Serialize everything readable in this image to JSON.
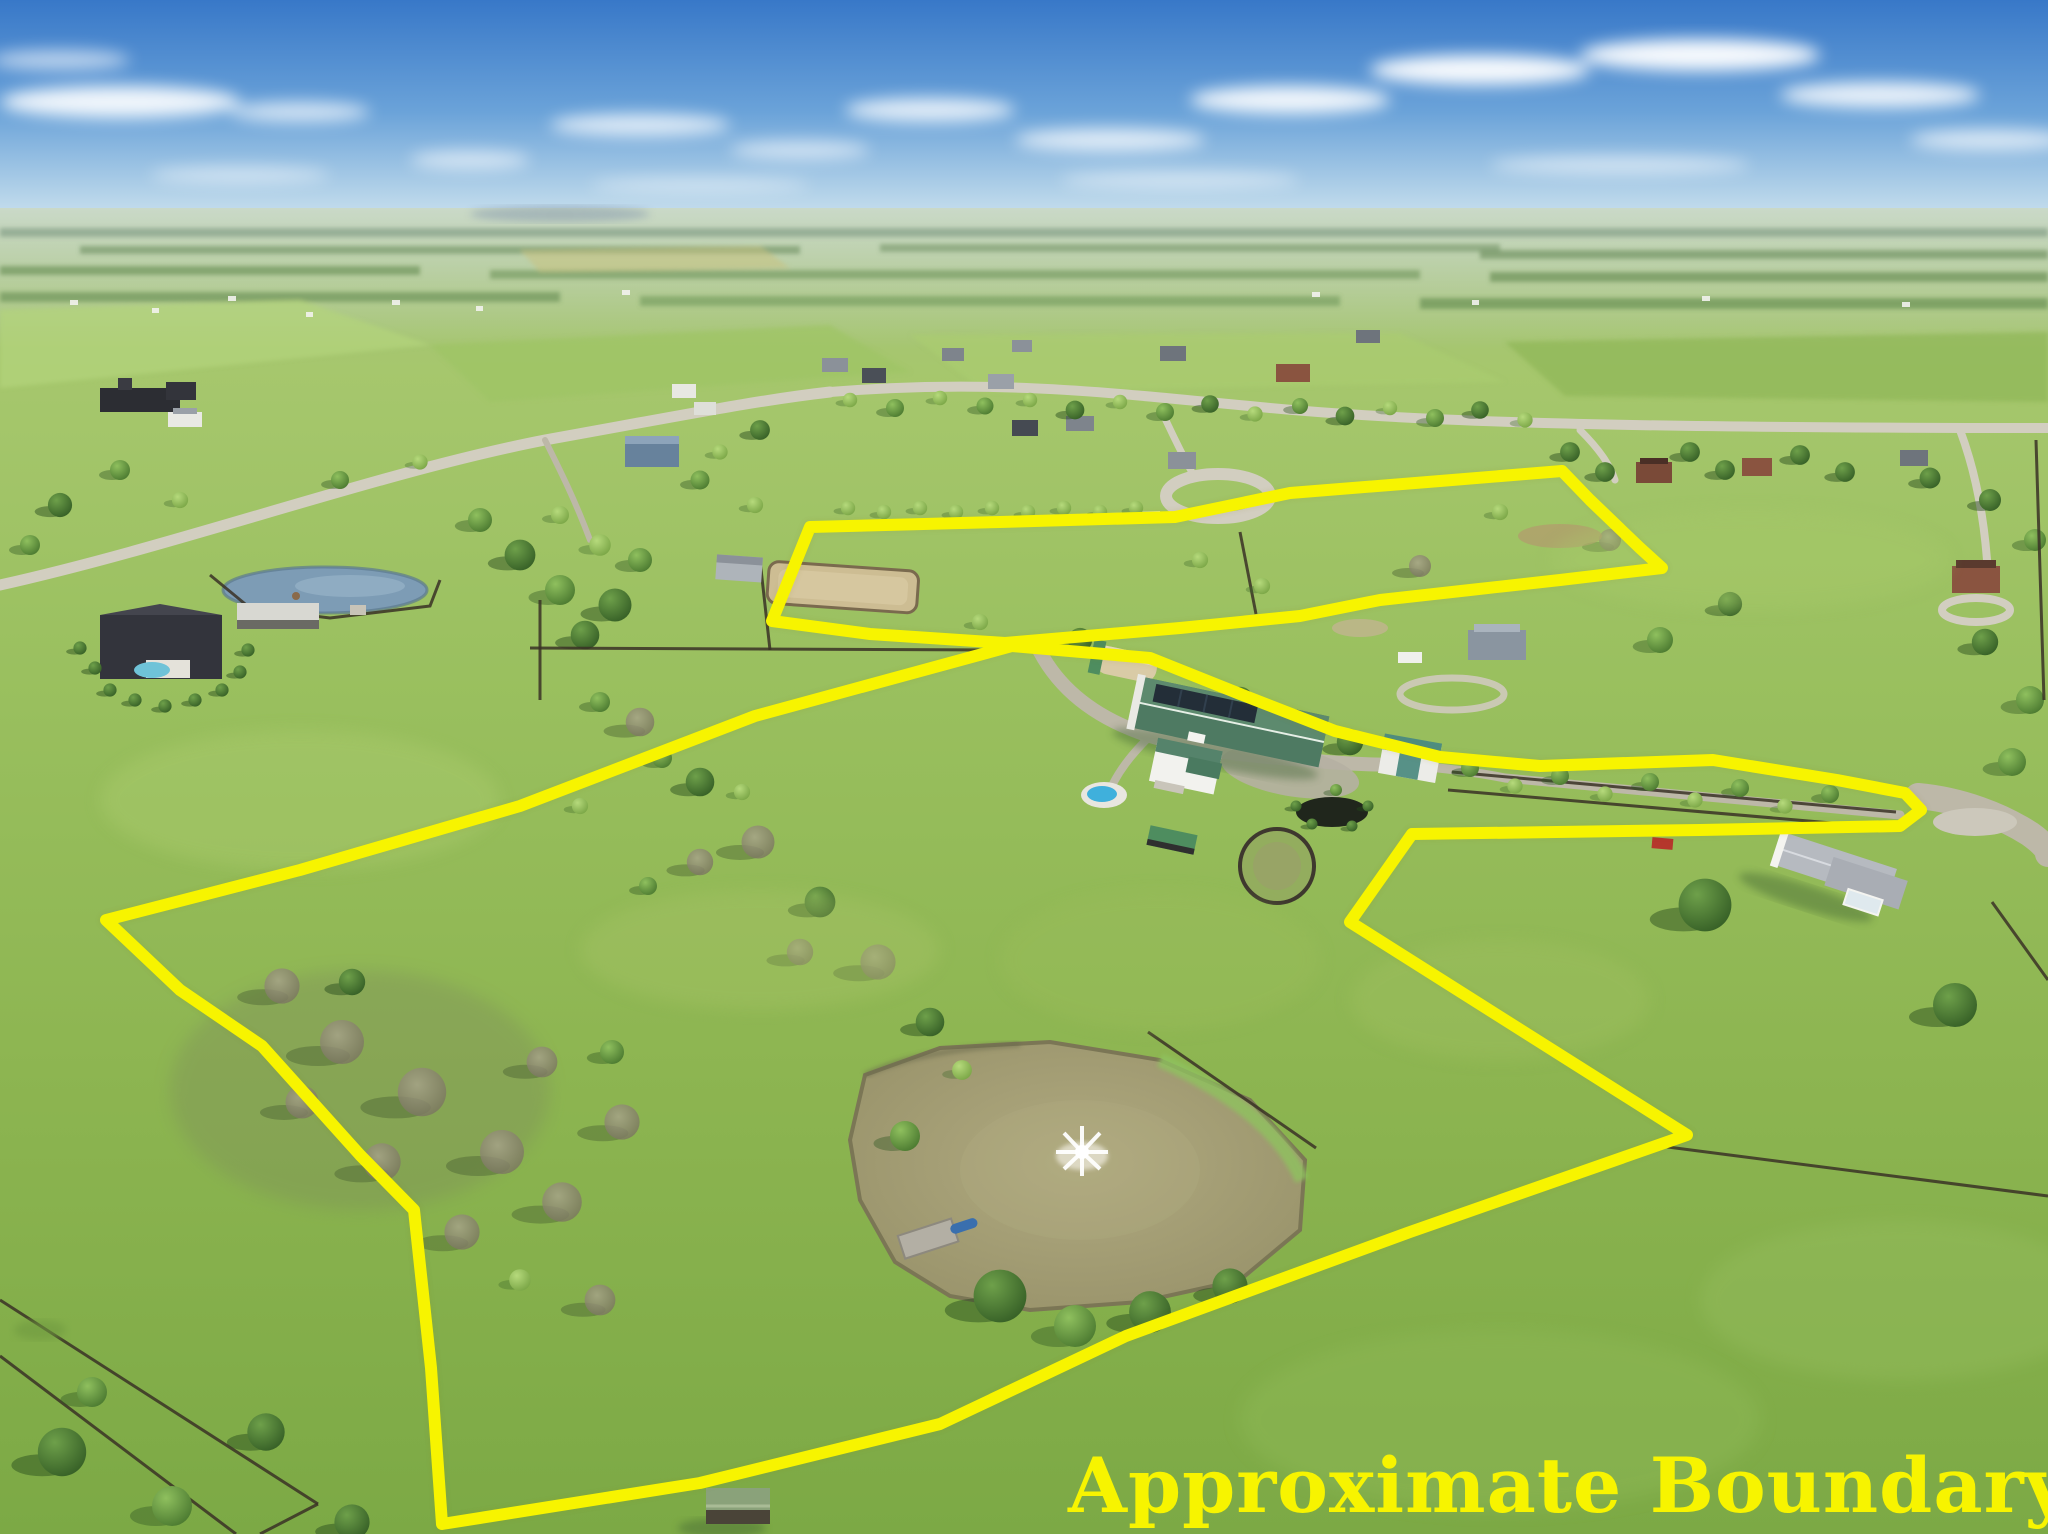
{
  "image": {
    "type": "aerial-drone-photograph",
    "title": "Aerial view of rural horse-farm property with boundary overlay"
  },
  "annotation": {
    "label": "Approximate Boundary",
    "line_color": "#f7f400",
    "line_width": 12,
    "parcels": [
      {
        "name": "main-parcel-boundary",
        "points": "1012,646 1150,658 1240,694 1335,731 1440,757 1540,766 1713,760 1837,780 1905,793 1921,810 1900,826 1700,830 1412,834 1350,922 1687,1135 1410,1232 1126,1336 940,1424 700,1483 442,1524 431,1368 414,1210 360,1155 262,1046 180,990 106,920 300,870 520,806 755,716"
      },
      {
        "name": "north-parcel-boundary",
        "points": "810,527 1000,522 1175,517 1290,493 1440,481 1562,471 1590,500 1640,548 1662,568 1560,580 1470,590 1380,600 1300,616 1180,628 1005,643 870,634 772,621"
      }
    ]
  },
  "scene": {
    "sky": {
      "zenith_color": "#3878c8",
      "horizon_color": "#e2eef5",
      "clouds": "scattered white cumulus and thin stratus"
    },
    "features": [
      {
        "name": "fountain-pond",
        "description": "large tan pond with aerator fountain, dock and blue boat"
      },
      {
        "name": "horse-barn",
        "description": "long green metal barn with solar panel array"
      },
      {
        "name": "riding-arena",
        "description": "fenced sand riding arena"
      },
      {
        "name": "round-pen",
        "description": "circular training pen"
      },
      {
        "name": "farm-house",
        "description": "white farmhouse with green roof, pool and patio"
      },
      {
        "name": "teal-roof-house",
        "description": "secondary house with teal cross-gable roof"
      },
      {
        "name": "hoop-barn",
        "description": "tan hooped hay barn"
      },
      {
        "name": "run-in-sheds",
        "description": "green-roofed run-in sheds in paddocks"
      },
      {
        "name": "tree-lined-lane",
        "description": "fenced farm lane running east toward neighboring house"
      },
      {
        "name": "white-farmhouse-east",
        "description": "neighboring white house with gray roof and circular drive"
      },
      {
        "name": "blue-pond-west",
        "description": "neighboring farm pond with fence"
      },
      {
        "name": "dark-roof-estate",
        "description": "dark-roofed estate home with pool and conifer rows"
      },
      {
        "name": "bare-tree-grove",
        "description": "grove of leafless trees with long shadows inside pasture"
      },
      {
        "name": "board-fences",
        "description": "dark four-board horse fencing"
      },
      {
        "name": "country-roads",
        "description": "light gray rural roads and subdivision street"
      },
      {
        "name": "distant-farmland",
        "description": "hazy patchwork of fields, tree rows and houses to horizon"
      }
    ]
  }
}
